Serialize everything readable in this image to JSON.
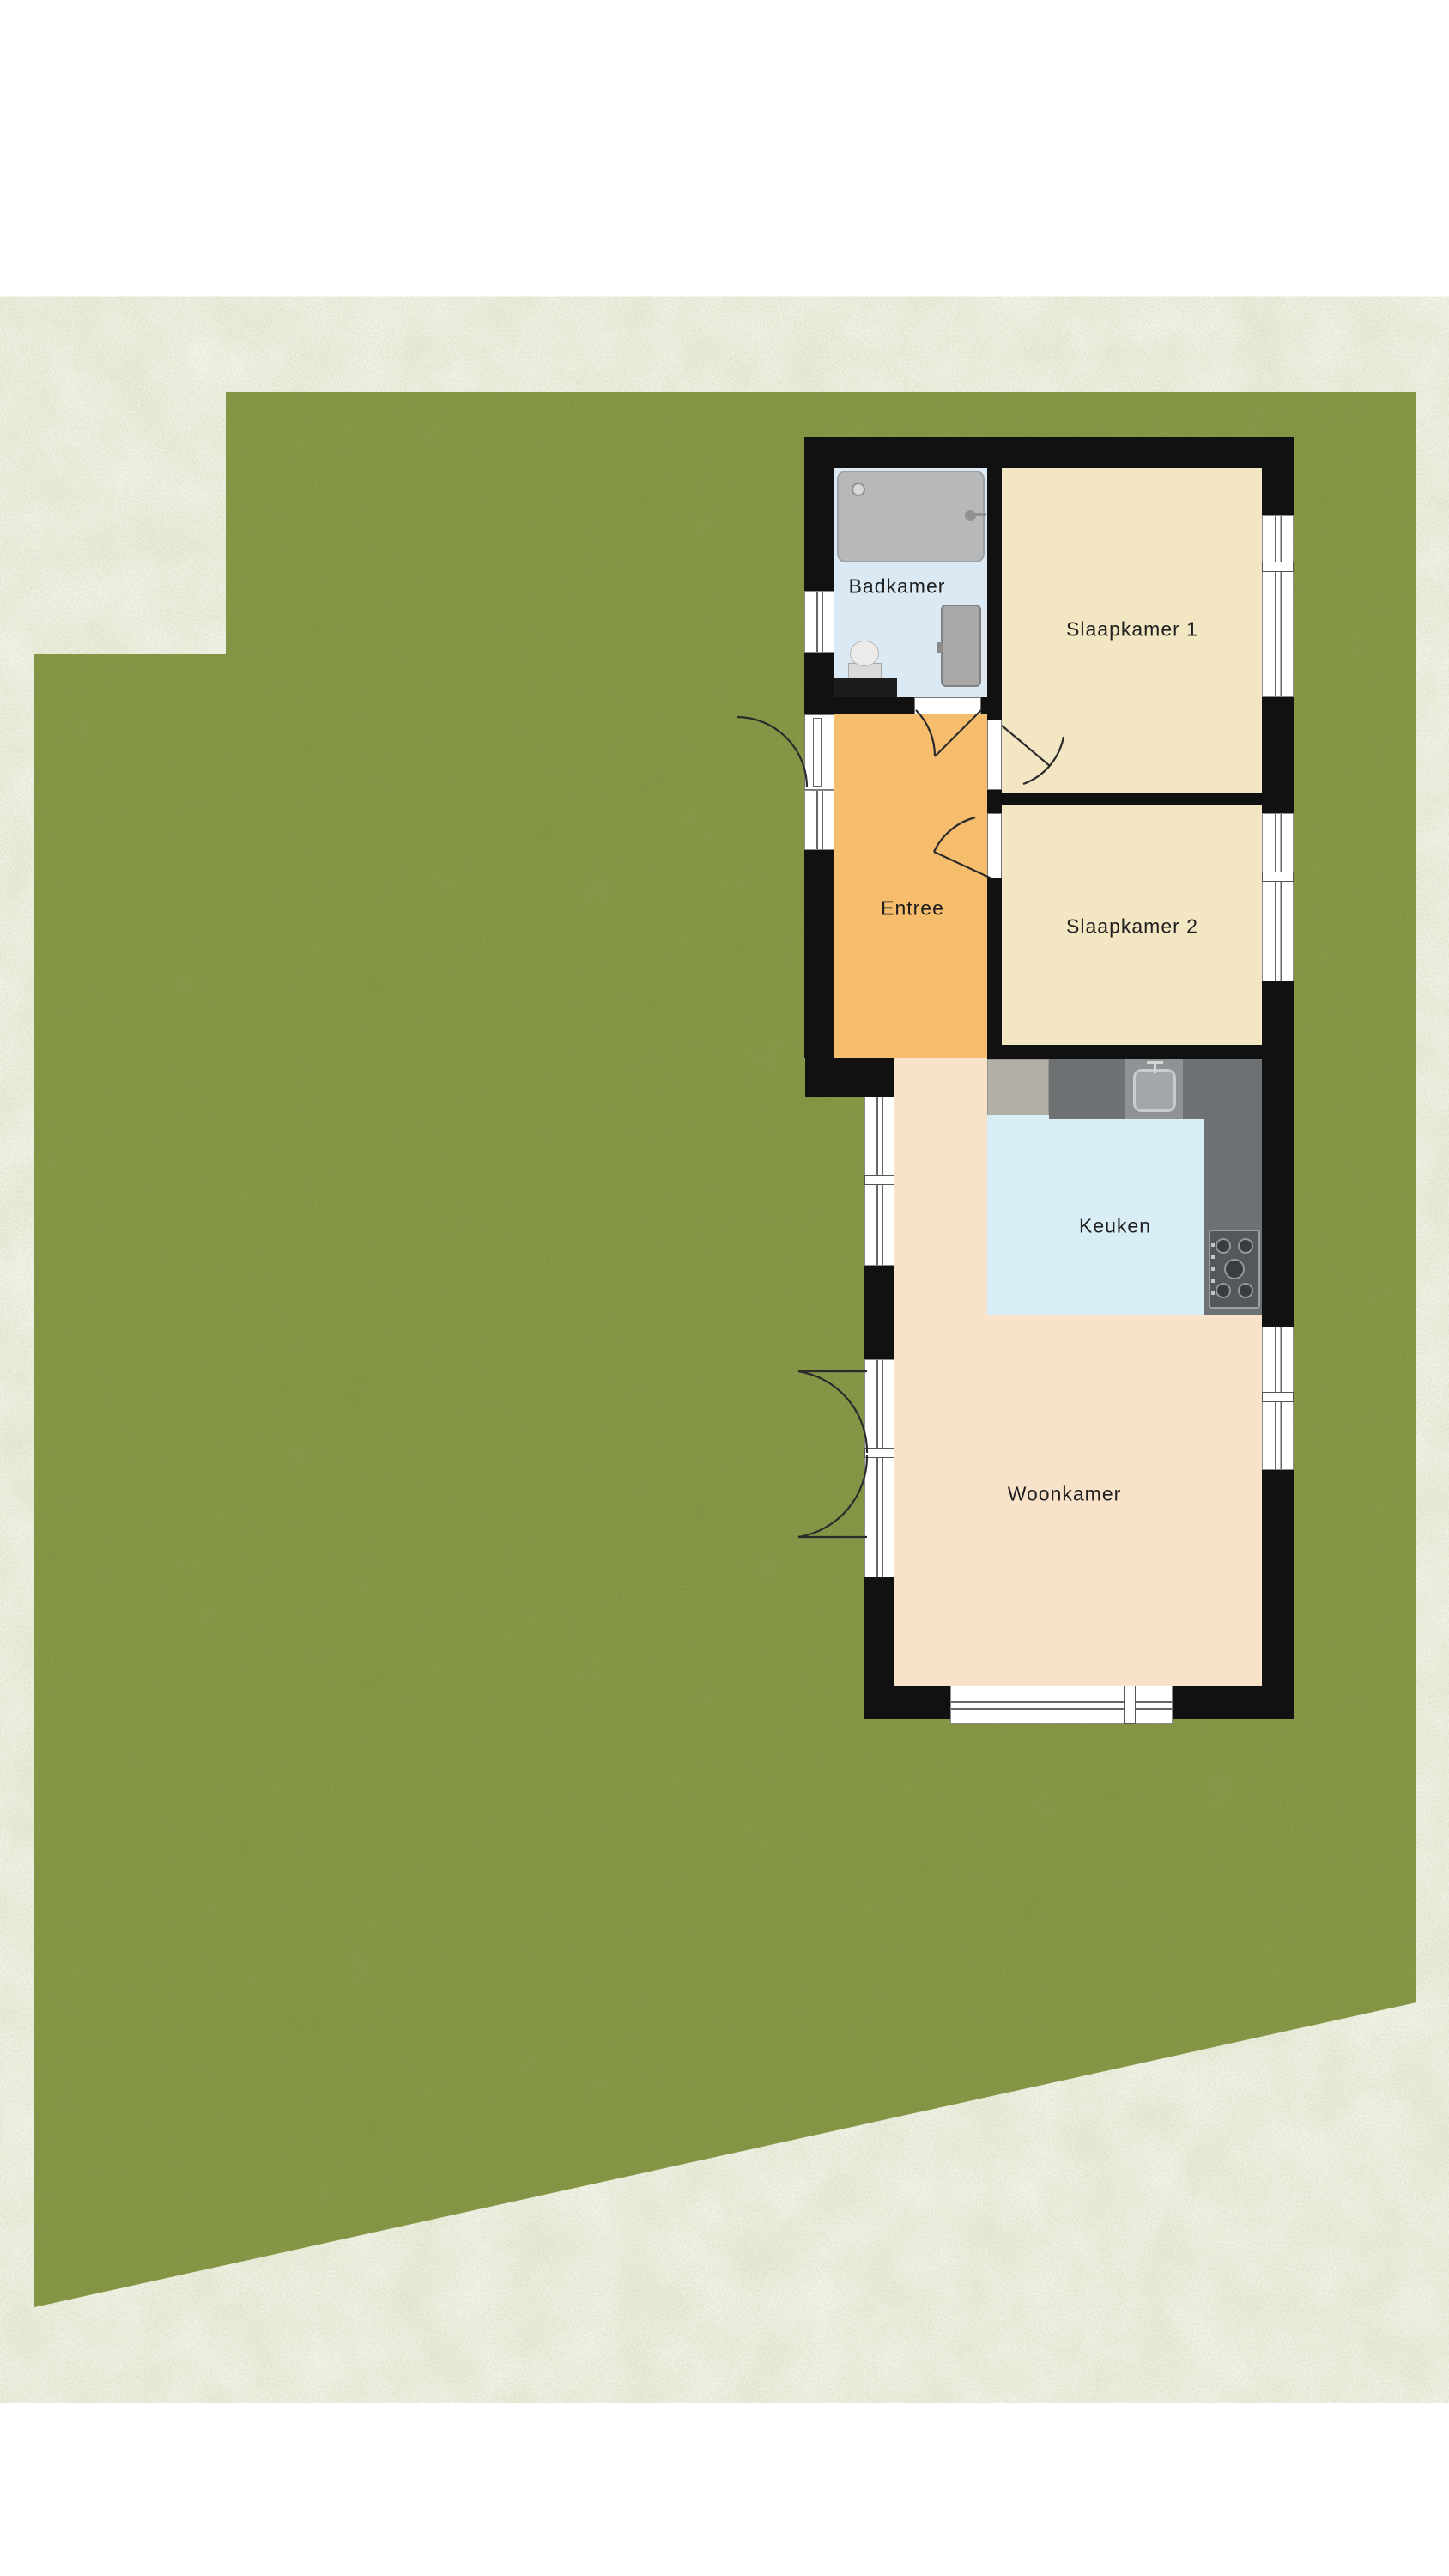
{
  "rooms": [
    {
      "id": "badkamer",
      "label": "Badkamer"
    },
    {
      "id": "slaapkamer1",
      "label": "Slaapkamer 1"
    },
    {
      "id": "slaapkamer2",
      "label": "Slaapkamer 2"
    },
    {
      "id": "entree",
      "label": "Entree"
    },
    {
      "id": "keuken",
      "label": "Keuken"
    },
    {
      "id": "woonkamer",
      "label": "Woonkamer"
    }
  ],
  "fixtures": [
    "shower-tray",
    "shower-drain",
    "shower-head",
    "toilet",
    "bathroom-vanity",
    "bathroom-door-leaf",
    "kitchen-appliance",
    "kitchen-sink",
    "faucet",
    "gas-hob",
    "countertop"
  ],
  "colors": {
    "grass": "#7c8e3e",
    "wall": "#111111",
    "bathroom_floor": "#dae9f4",
    "bedroom_floor": "#f2e7c2",
    "hall_floor": "#f6bd6c",
    "kitchen_floor": "#d8edf6",
    "living_floor": "#f8e3ca",
    "counter": "#6e7174",
    "fixture_gray": "#b6b8ba",
    "window_white": "#ffffff",
    "label_color": "#1f1f1f"
  }
}
